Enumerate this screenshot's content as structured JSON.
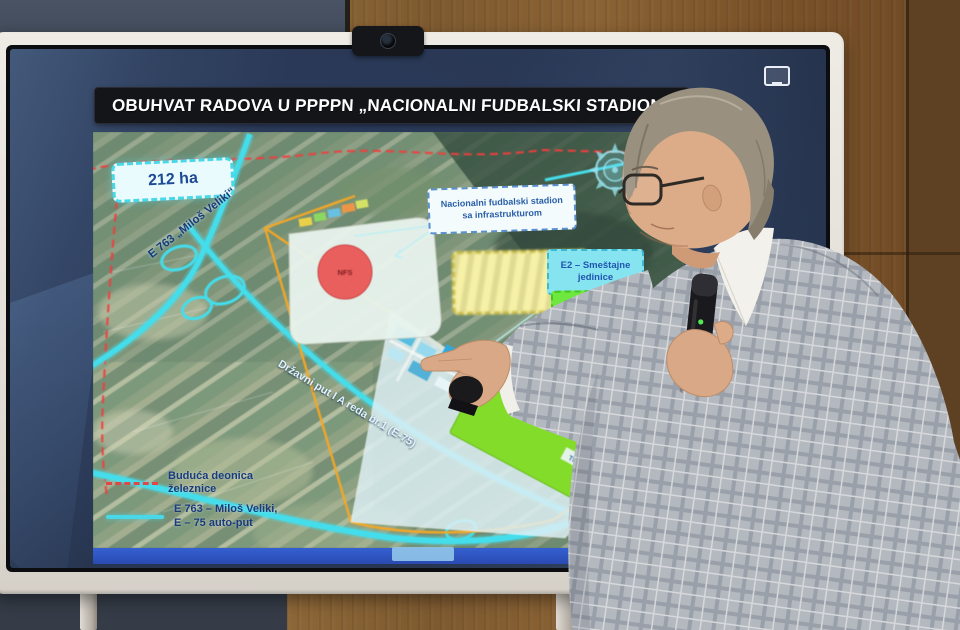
{
  "screen": {
    "title": "OBUHVAT RADOVA U PPPPN „NACIONALNI FUDBALSKI STADION“",
    "map": {
      "area_badge": "212 ha",
      "stadium_box_label": "Nacionalni fudbalski stadion sa infrastrukturom",
      "e2_box_label": "E2 – Smeštajne jedinice",
      "e1_box_label": "E1 – Sajam EX",
      "stadium_marker": "NFS",
      "road_label_e763": "E 763 „Miloš Veliki“",
      "road_label_e75": "Državni put I A reda br.1 (E-75)",
      "small_labels": [
        "MET",
        "TI"
      ],
      "legend": {
        "railway_line1": "Buduća deonica",
        "railway_line2": "železnice",
        "highway_line1": "E 763 – Miloš Veliki,",
        "highway_line2": "E – 75 auto-put"
      }
    }
  },
  "colors": {
    "highway_cyan": "#49d8e8",
    "railway_red": "#e84848",
    "boundary_orange": "#f0a830",
    "expo_green": "#84da2a",
    "screen_navy": "#273550",
    "strip_blue": "#2f55c4"
  }
}
